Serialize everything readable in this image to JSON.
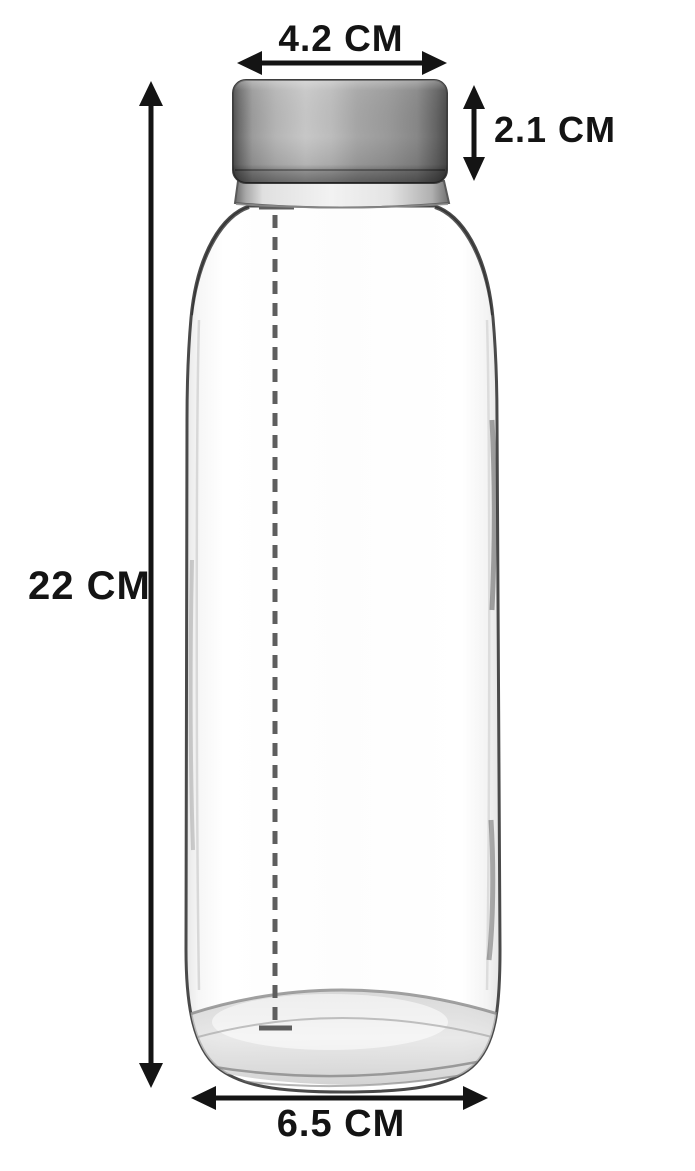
{
  "measurements": {
    "cap_width": "4.2 CM",
    "cap_height": "2.1 CM",
    "bottle_height": "22 CM",
    "base_width": "6.5 CM"
  },
  "subject": {
    "description": "clear glass water bottle with brushed stainless steel cap"
  },
  "icons": {
    "cap_width_arrow": "double-headed horizontal arrow",
    "cap_height_arrow": "double-headed vertical arrow",
    "bottle_height_arrow": "double-headed vertical arrow",
    "base_width_arrow": "double-headed horizontal arrow",
    "center_line": "vertical dashed measurement line with end ticks"
  },
  "colors": {
    "background": "#ffffff",
    "arrow": "#141414",
    "text": "#141414",
    "glass_edge": "#4a4a4a",
    "dashed_line": "#5e5e5e",
    "cap_dark": "#4b4b4b",
    "cap_light": "#c7c7c7"
  }
}
